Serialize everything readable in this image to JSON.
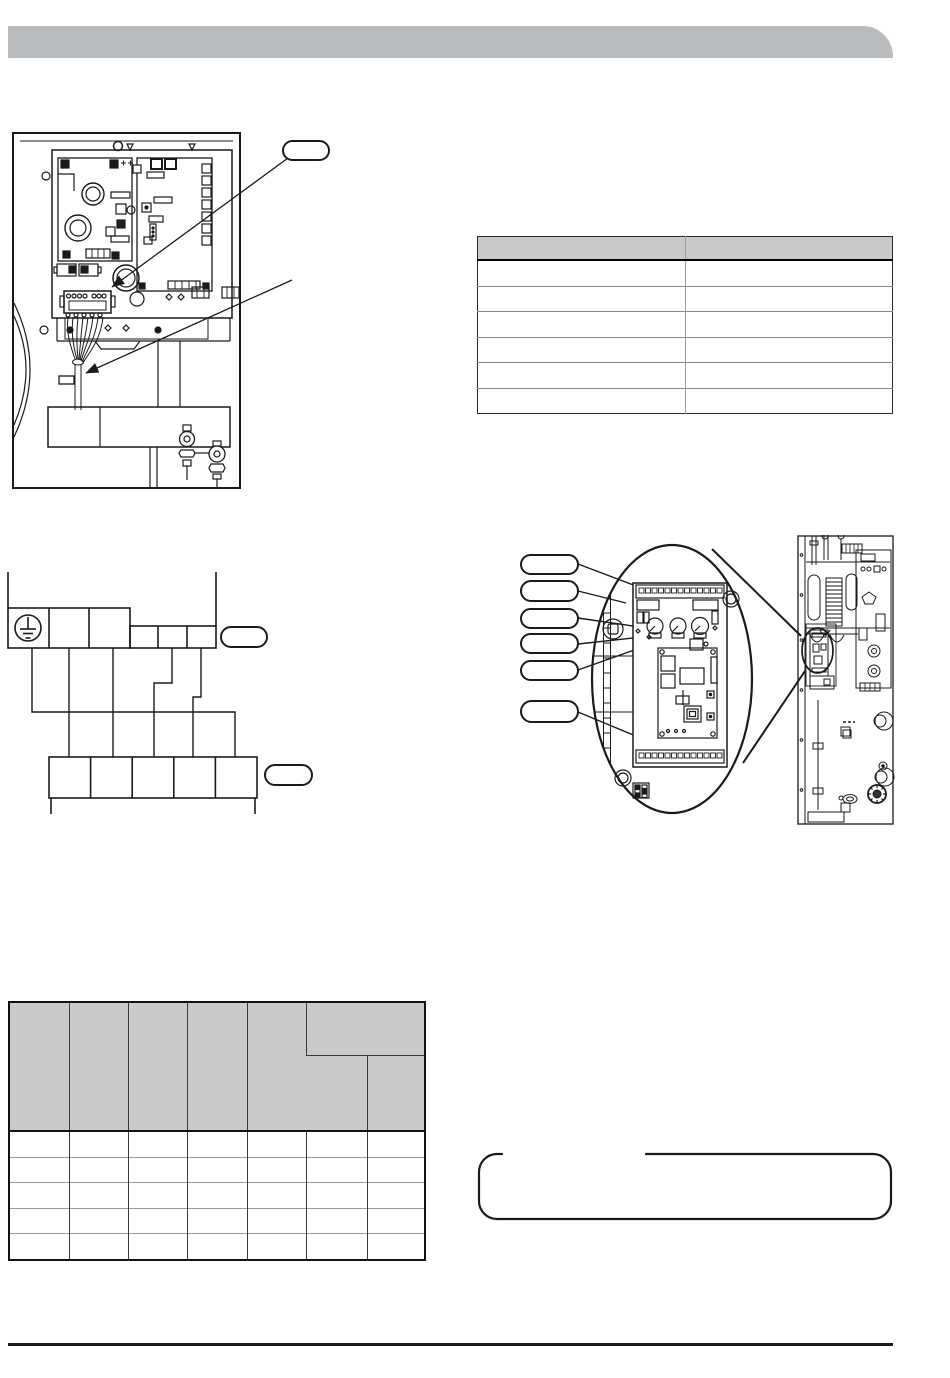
{
  "colors": {
    "header_bar": "#b9bcbe",
    "table_header_bg": "#cacaca",
    "line": "#1a1a1a"
  },
  "page": {
    "header_bar": {
      "label": ""
    },
    "note_box": {
      "text": ""
    }
  },
  "connection_table": {
    "columns": [
      "",
      ""
    ],
    "rows": [
      [
        "",
        ""
      ],
      [
        "",
        ""
      ],
      [
        "",
        ""
      ],
      [
        "",
        ""
      ],
      [
        "",
        ""
      ],
      [
        "",
        ""
      ]
    ]
  },
  "spec_table": {
    "header_row1": [
      "",
      "",
      "",
      "",
      "",
      ""
    ],
    "header_row2": [
      "",
      ""
    ],
    "rows": [
      [
        "",
        "",
        "",
        "",
        "",
        "",
        ""
      ],
      [
        "",
        "",
        "",
        "",
        "",
        "",
        ""
      ],
      [
        "",
        "",
        "",
        "",
        "",
        "",
        ""
      ],
      [
        "",
        "",
        "",
        "",
        "",
        "",
        ""
      ],
      [
        "",
        "",
        "",
        "",
        "",
        "",
        ""
      ]
    ]
  },
  "cabinet_diagram": {
    "callouts": [
      {
        "label": ""
      }
    ]
  },
  "wiring_diagram": {
    "callouts": [
      {
        "label": ""
      },
      {
        "label": ""
      }
    ]
  },
  "pcb_diagram": {
    "callouts": [
      {
        "label": ""
      },
      {
        "label": ""
      },
      {
        "label": ""
      },
      {
        "label": ""
      },
      {
        "label": ""
      },
      {
        "label": ""
      }
    ]
  }
}
